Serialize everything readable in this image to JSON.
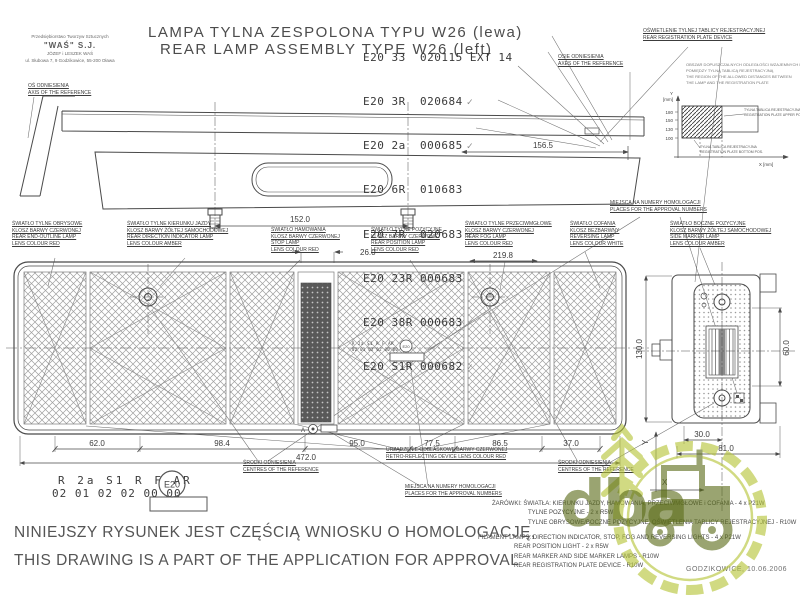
{
  "stamp": {
    "l1": "Przedsiębiorstwo Tworzyw Sztucznych",
    "l2": "\"WAŚ\" S.J.",
    "l3": "JÓZEF i LESZEK WAŚ",
    "l4": "ul. Słubowa 7, 9 Godzikowice, 55-200 Oława"
  },
  "axis_ref": {
    "pl": "OŚ ODNIESIENIA",
    "en": "AXIS OF THE REFERENCE"
  },
  "title": {
    "pl": "LAMPA TYLNA ZESPOLONA TYPU W26 (lewa)",
    "en": "REAR LAMP ASSEMBLY TYPE W26 (left)"
  },
  "approvals": [
    {
      "t": "E20 33  020115 EXT 14",
      "c": ""
    },
    {
      "t": "E20 3R  020684",
      "c": "✓"
    },
    {
      "t": "E20 2a  000685",
      "c": "✓"
    },
    {
      "t": "E20 6R  010683",
      "c": ""
    },
    {
      "t": "E20 7R  020683",
      "c": "✓"
    },
    {
      "t": "E20 23R 000683",
      "c": ""
    },
    {
      "t": "E20 38R 000683",
      "c": "✓"
    },
    {
      "t": "E20 S1R 000682",
      "c": "✓"
    }
  ],
  "axes_ref": {
    "pl": "OSIE ODNIESIENIA",
    "en": "AXES OF THE REFERENCE"
  },
  "reg_plate": {
    "pl": "OŚWIETLENIE TYLNEJ TABLICY REJESTRACYJNEJ",
    "en": "REAR REGISTRATION PLATE DEVICE"
  },
  "inset": {
    "notes_1": "OBSZAR DOPUSZCZALNYCH ODLEGŁOŚCI WZAJEMNYCH LAMPY",
    "notes_2": "POMIĘDZY TYLNĄ TABLICĄ REJESTRACYJNĄ",
    "notes_3": "THE REGION OF THE ALLOWED DISTANCES BETWEEN",
    "notes_4": "THE LAMP AND THE REGISTRATION PLATE",
    "y_axis": "Y",
    "y_unit": "[mm]",
    "x_unit": "X [mm]",
    "tick_1": "180",
    "tick_2": "150",
    "tick_3": "130",
    "tick_4": "100",
    "upper_1": "TYLNA TABLICA REJESTRACYJNA",
    "upper_2": "REGISTRATION PLATE UPPER POS.",
    "lower_1": "TYLNA TABLICA REJESTRACYJNA",
    "lower_2": "REGISTRATION PLATE BOTTOM POS."
  },
  "labels": {
    "outline": {
      "l1": "ŚWIATŁO TYLNE OBRYSOWE",
      "l2": "KLOSZ BARWY CZERWONEJ",
      "l3": "REAR END-OUTLINE LAMP",
      "l4": "LENS COLOUR RED"
    },
    "indicator": {
      "l1": "ŚWIATŁO TYLNE KIERUNKU JAZDY",
      "l2": "KLOSZ BARWY ŻÓŁTEJ SAMOCHODOWEJ",
      "l3": "REAR DIRECTION INDICATOR LAMP",
      "l4": "LENS COLOUR AMBER"
    },
    "stop": {
      "l1": "ŚWIATŁO HAMOWANIA",
      "l2": "KLOSZ BARWY CZERWONEJ",
      "l3": "STOP LAMP",
      "l4": "LENS COLOUR RED"
    },
    "position": {
      "l1": "ŚWIATŁO TYLNE POZYCYJNE",
      "l2": "KLOSZ BARWY CZERWONEJ",
      "l3": "REAR POSITION LAMP",
      "l4": "LENS COLOUR RED"
    },
    "fog": {
      "l1": "ŚWIATŁO TYLNE PRZECIWMGŁOWE",
      "l2": "KLOSZ BARWY CZERWONEJ",
      "l3": "REAR FOG LAMP",
      "l4": "LENS COLOUR RED"
    },
    "reversing": {
      "l1": "ŚWIATŁO COFANIA",
      "l2": "KLOSZ BEZBARWNY",
      "l3": "REVERSING LAMP",
      "l4": "LENS COLOUR WHITE"
    },
    "side_marker": {
      "l1": "ŚWIATŁO BOCZNE POZYCYJNE",
      "l2": "KLOSZ BARWY ŻÓŁTEJ SAMOCHODOWEJ",
      "l3": "SIDE MARKER LAMP",
      "l4": "LENS COLOUR AMBER"
    },
    "approval_places": {
      "l1": "MIEJSCA NA NUMERY HOMOLOGACJI",
      "l2": "PLACES FOR THE APPROVAL NUMBERS"
    },
    "centres": {
      "l1": "ŚRODKI ODNIESIENIA",
      "l2": "CENTRES OF THE REFERENCE"
    },
    "retro": {
      "l1": "URZĄDZENIE ODBLASKOWE BARWY CZERWONEJ",
      "l2": "RETRO-REFLECTING DEVICE LENS COLOUR RED"
    }
  },
  "dims": {
    "d156": "156.5",
    "d152": "152.0",
    "d26": "26.0",
    "d219": "219.8",
    "d62": "62.0",
    "d98": "98.4",
    "d95": "95.0",
    "d77": "77.5",
    "d86": "86.5",
    "d37": "37.0",
    "d472": "472.0",
    "d130": "130.0",
    "d60": "60.0",
    "d30": "30.0",
    "d81": "81.0",
    "ax_x": "X",
    "ax_y": "Y"
  },
  "marking": {
    "row1": "R 2a S1 R F AR",
    "row2": "02 01 02 02 00 00",
    "e_mark": "E20",
    "a": "A"
  },
  "bulbs": {
    "pl_1": "ŻARÓWKI: ŚWIATŁA: KIERUNKU JAZDY, HAMOWANIA, PRZECIWMGŁOWE i COFANIA - 4 x P21W",
    "pl_2": "TYLNE POZYCYJNE - 2 x R5W",
    "pl_3": "TYLNE OBRYSOWE/BOCZNE POZYCYJNE, OŚWIETLENIA TABLICY REJESTRACYJNEJ - R10W",
    "en_1": "FILAMENT LAMPS: DIRECTION INDICATOR, STOP, FOG AND REVERSING LIGHTS - 4 x P21W",
    "en_2": "REAR POSITION LIGHT - 2 x R5W",
    "en_3": "REAR MARKER AND SIDE MARKER LAMPS - R10W",
    "en_4": "REAR REGISTRATION PLATE DEVICE - R10W"
  },
  "footer": {
    "pl": "NINIEJSZY RYSUNEK JEST CZĘŚCIĄ WNIOSKU O HOMOLOGACJĘ,",
    "en": "THIS DRAWING IS A PART OF THE APPLICATION FOR APPROVAL",
    "date": "GODZIKOWICE, 10.06.2006"
  },
  "watermark": {
    "text": "dba"
  },
  "colors": {
    "line": "#4a4a4a",
    "lime": "#b5c437",
    "olive": "#5d6e1b"
  }
}
